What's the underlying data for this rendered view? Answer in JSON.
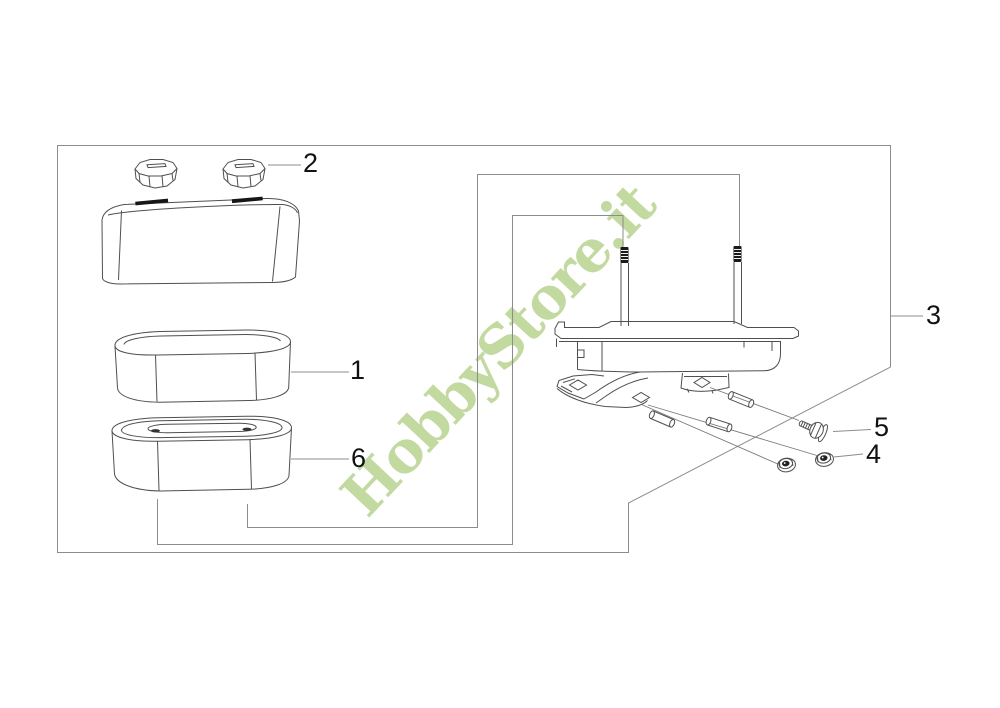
{
  "watermark": {
    "text": "HobbyStore.it",
    "color": "#b5d18c"
  },
  "callouts": {
    "filter_element": "1",
    "knob": "2",
    "assembly": "3",
    "nut": "4",
    "bolt": "5",
    "filter_element_alt": "6"
  },
  "colors": {
    "background": "#ffffff",
    "group_box_line": "#8c8c8c",
    "part_line": "#4f4f4f",
    "stud_thread": "#1a1a1a",
    "label_text": "#121212"
  }
}
